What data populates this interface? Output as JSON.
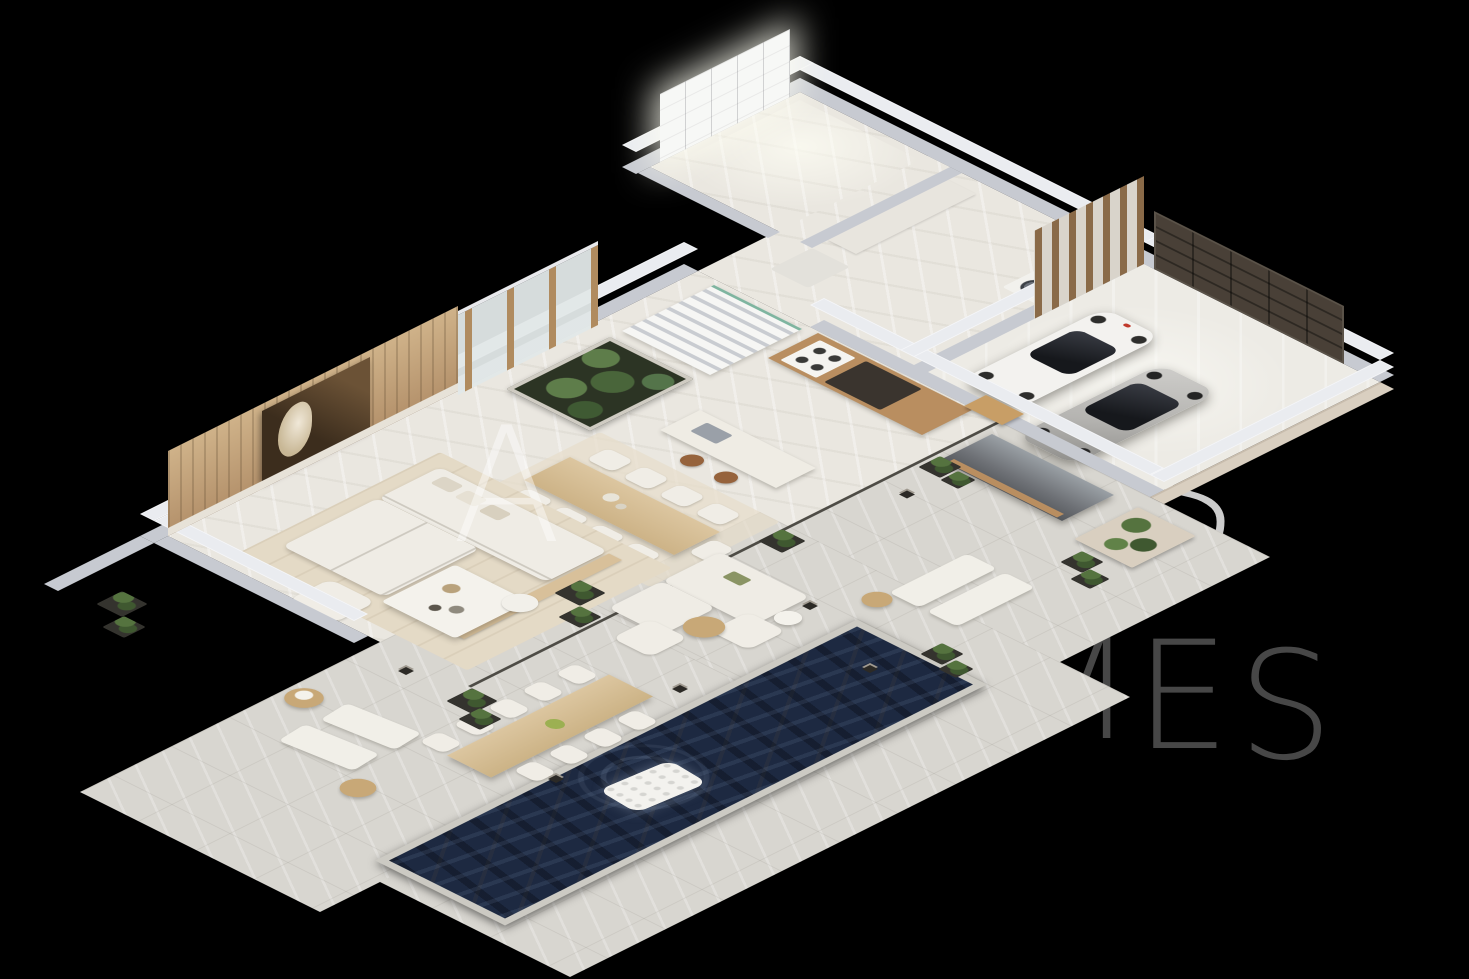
{
  "scene": {
    "title": "Isometric 3D floor-plan rendering of a modern luxury villa",
    "background": "#000000",
    "watermark": {
      "color": "#ffffff",
      "letters": [
        {
          "char": "M"
        },
        {
          "char": "A"
        },
        {
          "char": "S"
        },
        {
          "char": "M"
        },
        {
          "char": "E"
        },
        {
          "char": "S"
        }
      ]
    },
    "palette": {
      "bg": "#000000",
      "floor_indoor": "#eae7e0",
      "floor_terrace": "#d8d6d0",
      "floor_garage": "#edebe5",
      "wall_side": "#c7cad1",
      "wall_top": "#eaecf0",
      "wood": "#b98e60",
      "wood_light": "#d8c09a",
      "stone": "#d9cfc0",
      "sofa": "#efece5",
      "rug": "#e4dac6",
      "pool_water": "#1d2941",
      "pool_coping": "#cccac3",
      "plant": "#55733f",
      "plant_dark": "#3f5830",
      "garage_door": "#494037",
      "car_white": "#f3f2ef",
      "car_silver": "#b5b4b1",
      "gold": "#c89e66",
      "glass_dark": "#24262b",
      "watermark": "#ffffff"
    },
    "rooms": [
      {
        "name": "living-room"
      },
      {
        "name": "dining-area"
      },
      {
        "name": "kitchen"
      },
      {
        "name": "entry-hall-stairs"
      },
      {
        "name": "interior-garden"
      },
      {
        "name": "walk-in-closet"
      },
      {
        "name": "laundry-utility-room"
      },
      {
        "name": "garage"
      },
      {
        "name": "terrace"
      },
      {
        "name": "swimming-pool"
      }
    ],
    "furnishings": [
      {
        "name": "l-shaped-sofa"
      },
      {
        "name": "coffee-table"
      },
      {
        "name": "armchair"
      },
      {
        "name": "indoor-dining-table-8-chairs"
      },
      {
        "name": "kitchen-island-2-stools"
      },
      {
        "name": "staircase"
      },
      {
        "name": "wardrobe-wall"
      },
      {
        "name": "washer-dryer"
      },
      {
        "name": "white-convertible-sports-car"
      },
      {
        "name": "silver-sports-car"
      },
      {
        "name": "sectional-garage-door"
      },
      {
        "name": "outdoor-kitchen-counter"
      },
      {
        "name": "outdoor-dining-table-9-chairs"
      },
      {
        "name": "outdoor-lounge-set"
      },
      {
        "name": "sun-loungers"
      },
      {
        "name": "pool-float"
      },
      {
        "name": "cactus-pots"
      },
      {
        "name": "bollard-lights"
      }
    ]
  }
}
